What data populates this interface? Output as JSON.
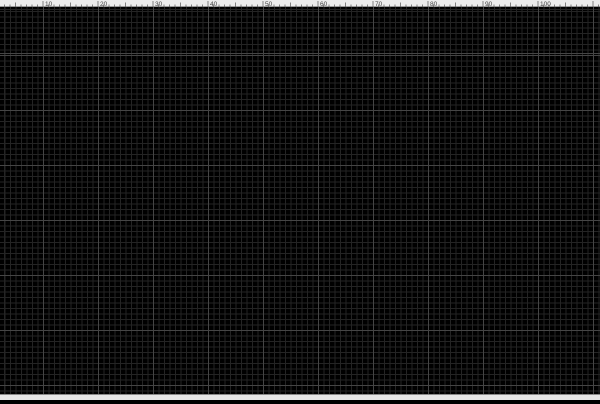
{
  "ruler": {
    "labels": [
      "10",
      "20",
      "30",
      "40",
      "50",
      "60",
      "70",
      "80",
      "90",
      "100"
    ]
  },
  "board": {
    "input_header": {
      "plus": "+",
      "minus": "-",
      "in1": "IN1",
      "in2": "IN2"
    },
    "i2c_header": {
      "sda": "SDA",
      "scl": "SCL",
      "plus": "+",
      "minus": "-"
    },
    "power_header": {
      "minus": "-",
      "plus": "+"
    },
    "mcu": {
      "sda": "SDA",
      "scl": "SCL",
      "pin_numbers": [
        "9",
        "8",
        "7",
        "6",
        "5",
        "4",
        "3"
      ]
    },
    "io_blocks": {
      "led": "LED",
      "sw_minus": "SW-",
      "sw_plus": "SW+"
    },
    "sensor": {
      "pin0": "0",
      "minus": "-",
      "plus": "+",
      "name": "DS18B20"
    }
  },
  "colors": {
    "background": "#000000",
    "grid_minor": "#242424",
    "grid_major": "#454545",
    "trace_green": "#0aa30a",
    "silk_yellow": "#b9a72e",
    "label_yellow": "#d3c13a",
    "pad_hole": "#000000",
    "mount_ring": "#ead500",
    "component_red": "#bb2222",
    "ruler_bg": "#ececec"
  }
}
